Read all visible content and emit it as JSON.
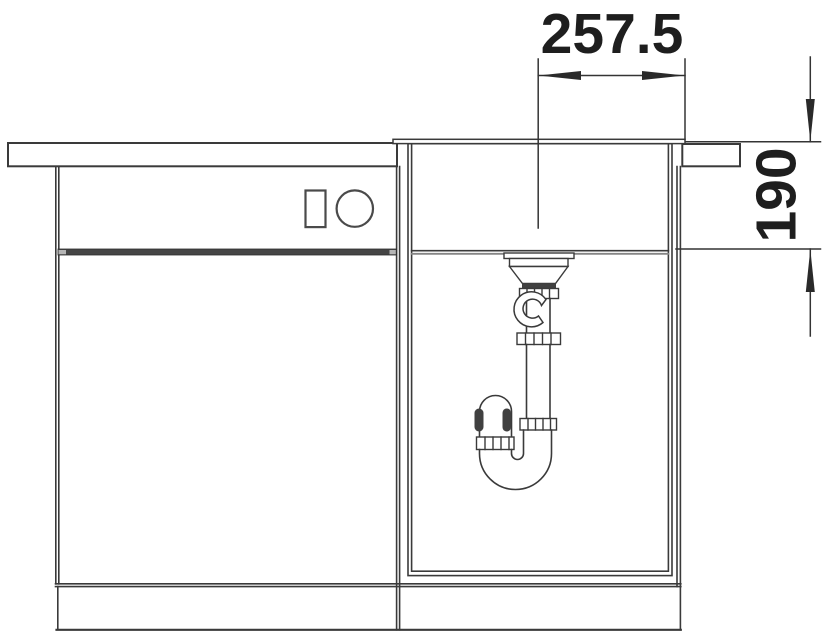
{
  "drawing": {
    "kind": "sink-installation-section-drawing",
    "background_color": "#ffffff",
    "line_color": "#3a3a3a",
    "text_color": "#1e1e1e",
    "dimensions": {
      "drain_offset": {
        "label": "257.5",
        "orientation": "horizontal"
      },
      "bowl_depth": {
        "label": "190",
        "orientation": "vertical"
      }
    },
    "components": {
      "countertop": "countertop-section-hatched",
      "sink_rim": "flush-sink-rim",
      "sink_bowl": "sink-bowl-section",
      "drain": "drain-flange-assembly",
      "siphon": "siphon-p-trap",
      "cabinet_left": "base-cabinet-front",
      "cabinet_sink": "sink-base-cabinet-section",
      "plinth": "plinth-panel",
      "drawer_gap": "drawer-gap-bar",
      "knobs": "rectangle-and-circle-symbols"
    }
  }
}
